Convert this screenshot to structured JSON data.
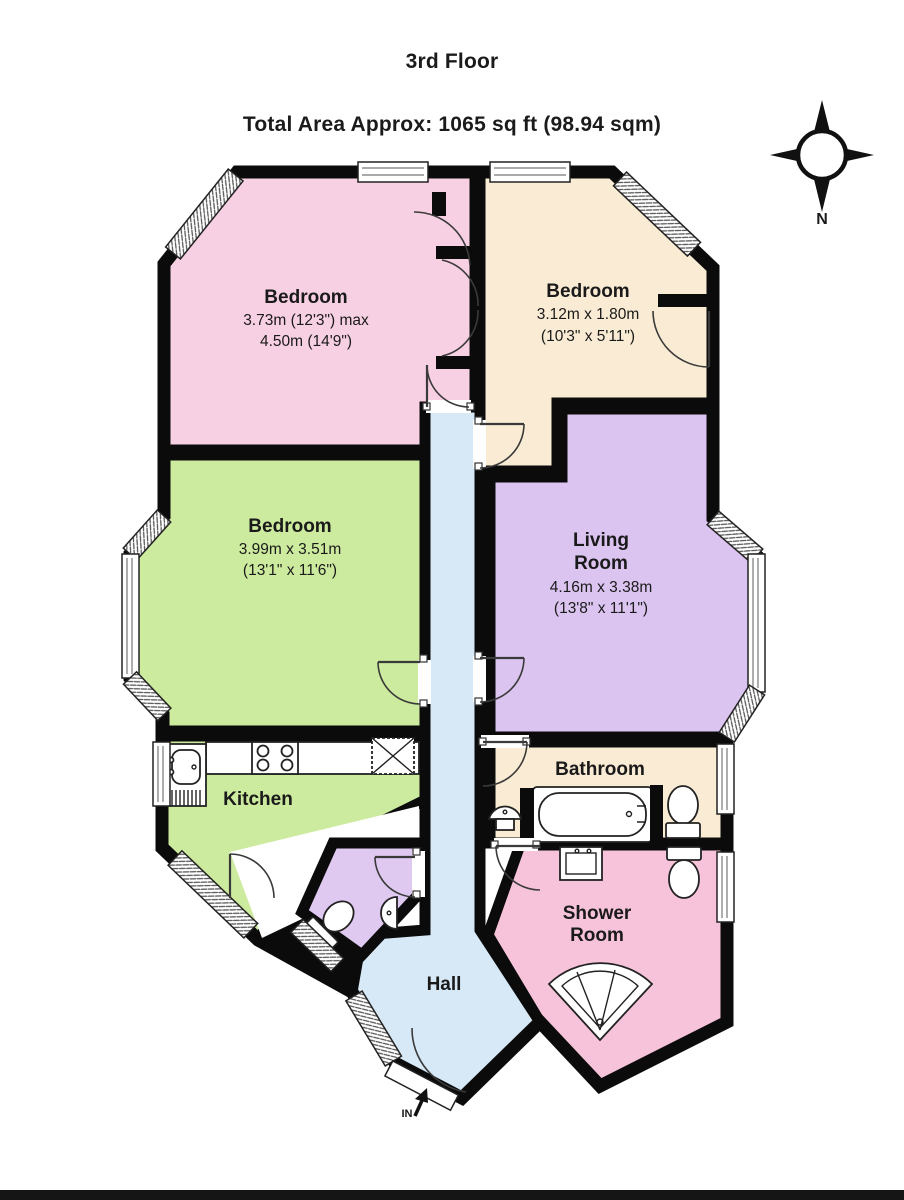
{
  "header": {
    "floor": "3rd Floor",
    "area": "Total Area Approx: 1065 sq ft (98.94 sqm)"
  },
  "compass": {
    "north_label": "N"
  },
  "entrance": {
    "label": "IN"
  },
  "colors": {
    "wall": "#0b0b0b",
    "bedroom1": "#f8d0e3",
    "bedroom2": "#faecd4",
    "bedroom3": "#cdeb9e",
    "living_room": "#dbc4ef",
    "kitchen": "#cdeb9e",
    "bathroom": "#faecd4",
    "shower_room": "#f7c3da",
    "wc": "#dfc9f1",
    "hall": "#d7e9f7"
  },
  "rooms": {
    "bedroom1": {
      "name": "Bedroom",
      "dim_line1": "3.73m (12'3\") max",
      "dim_line2": "4.50m (14'9\")"
    },
    "bedroom2": {
      "name": "Bedroom",
      "dim_line1": "3.12m x 1.80m",
      "dim_line2": "(10'3\" x 5'11\")"
    },
    "bedroom3": {
      "name": "Bedroom",
      "dim_line1": "3.99m x 3.51m",
      "dim_line2": "(13'1\" x 11'6\")"
    },
    "living_room": {
      "name_line1": "Living",
      "name_line2": "Room",
      "dim_line1": "4.16m x 3.38m",
      "dim_line2": "(13'8\" x 11'1\")"
    },
    "kitchen": {
      "name": "Kitchen"
    },
    "bathroom": {
      "name": "Bathroom"
    },
    "shower_room": {
      "name_line1": "Shower",
      "name_line2": "Room"
    },
    "hall": {
      "name": "Hall"
    }
  }
}
